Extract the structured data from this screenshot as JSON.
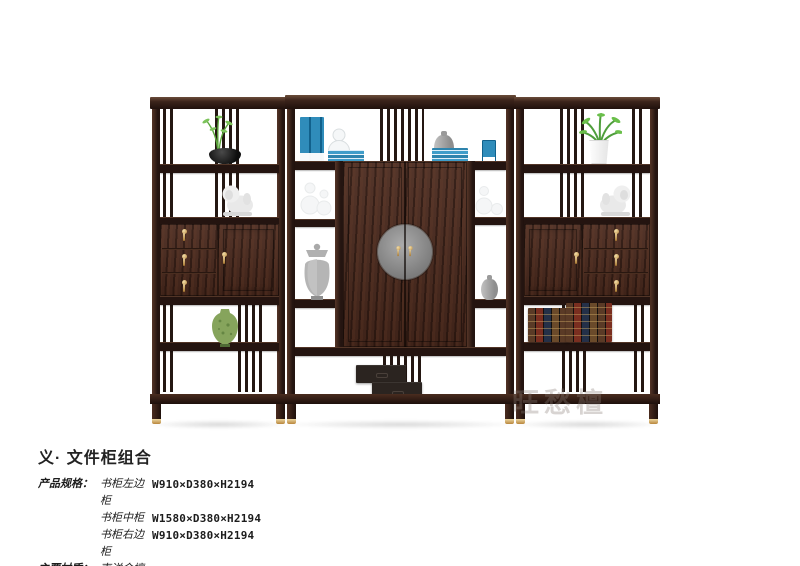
{
  "watermark": "旺愁檀",
  "product": {
    "title": "义· 文件柜组合",
    "spec_label": "产品规格：",
    "material_label": "主要材质：",
    "material_value": "南洋金檀",
    "specs": [
      {
        "name": "书柜左边柜",
        "dims": "W910×D380×H2194"
      },
      {
        "name": "书柜中柜",
        "dims": "W1580×D380×H2194"
      },
      {
        "name": "书柜右边柜",
        "dims": "W910×D380×H2194"
      }
    ]
  },
  "palette": {
    "background": "#ffffff",
    "wood_dark": "#241410",
    "wood_mid": "#4a291d",
    "brass": "#c8a05c",
    "medallion_gray": "#8c8c8c",
    "book_blue": "#2f8cba",
    "plant_green": "#5da73e",
    "vase_green": "#86a45c",
    "statue_gray": "#e8e8e8",
    "text": "#1c1c1c"
  }
}
